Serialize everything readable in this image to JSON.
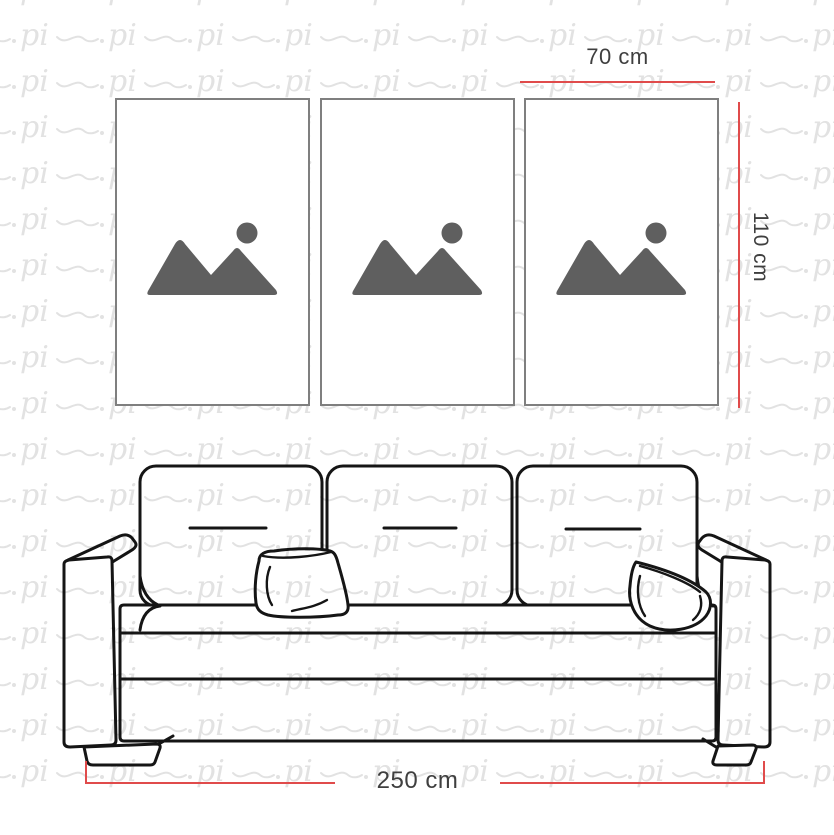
{
  "watermark": {
    "text": "pi"
  },
  "size_guide": {
    "panel_width_label": "70 cm",
    "panel_height_label": "110 cm",
    "sofa_width_label": "250 cm"
  },
  "panels": [
    {
      "name": "art-panel-1",
      "icon": "image-placeholder-icon"
    },
    {
      "name": "art-panel-2",
      "icon": "image-placeholder-icon"
    },
    {
      "name": "art-panel-3",
      "icon": "image-placeholder-icon"
    }
  ],
  "colors": {
    "background": "#ffffff",
    "dimension_line": "#e04b4b",
    "label_text": "#3f3f3f",
    "frame_border": "#7f7f7f",
    "placeholder_icon": "#5f5f5f",
    "sofa_outline": "#151515",
    "watermark": "#e2e2e2"
  }
}
